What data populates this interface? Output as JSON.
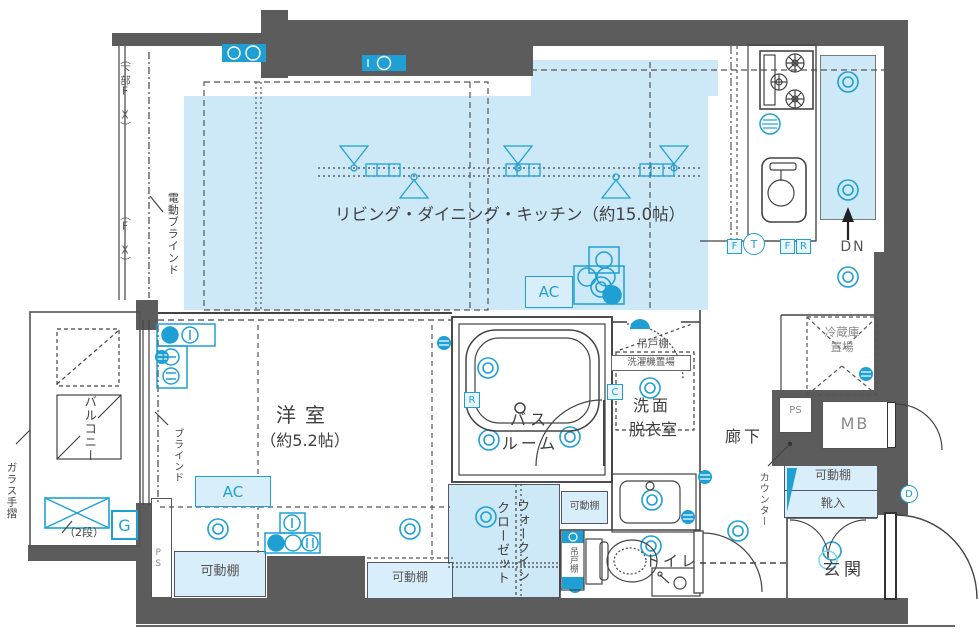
{
  "labels": {
    "ldk": "リビング・ダイニング・キッチン（約15.0帖）",
    "bedroom": "洋室",
    "bedroom_size": "（約5.2帖）",
    "bath1": "バス",
    "bath2": "ルーム",
    "wash1": "洗面",
    "wash2": "脱衣室",
    "hallway": "廊下",
    "toilet": "トイレ",
    "entrance": "玄関",
    "wic1": "ウォークイン",
    "wic2": "クローゼット",
    "balcony": "バルコニー",
    "glass_rail": "ガラス手摺",
    "two_tier": "（2段）",
    "g": "G",
    "ps_side": "PS",
    "ps": "PS",
    "mb": "MB",
    "dn": "DN",
    "fridge1": "冷蔵庫",
    "fridge2": "置場",
    "counter": "カウンター",
    "shelf": "可動棚",
    "shoe": "靴入",
    "hanging_cupboard": "吊戸棚",
    "washer_space": "洗濯機置場",
    "hanging_cupboard_toilet": "吊戸棚",
    "electric_blind": "電動ブラインド",
    "blind": "ブラインド",
    "lower_fix": "（下部FIX）",
    "fix": "（FIX）",
    "ac": "AC",
    "f": "F",
    "t": "T",
    "r": "R",
    "r_bath": "R",
    "c": "C",
    "d": "D"
  },
  "colors": {
    "wall": "#5c5c5c",
    "floor_blue": "#cde9f8",
    "box_blue": "#d9eefb",
    "accent_cyan": "#1fa0d4"
  }
}
